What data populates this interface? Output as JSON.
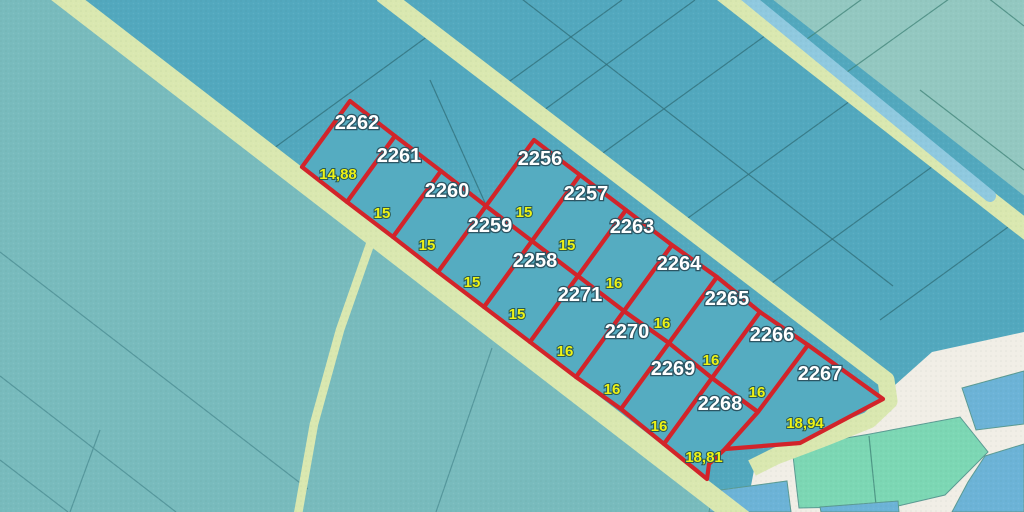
{
  "map": {
    "parcels": [
      {
        "number": "2262"
      },
      {
        "number": "2261"
      },
      {
        "number": "2260"
      },
      {
        "number": "2259"
      },
      {
        "number": "2258"
      },
      {
        "number": "2271"
      },
      {
        "number": "2270"
      },
      {
        "number": "2269"
      },
      {
        "number": "2268"
      },
      {
        "number": "2256"
      },
      {
        "number": "2257"
      },
      {
        "number": "2263"
      },
      {
        "number": "2264"
      },
      {
        "number": "2265"
      },
      {
        "number": "2266"
      },
      {
        "number": "2267"
      }
    ],
    "frontage_labels": [
      "14,88",
      "15",
      "15",
      "15",
      "15",
      "16",
      "16",
      "16",
      "18,81"
    ],
    "inner_labels": [
      "15",
      "15",
      "16",
      "16",
      "16",
      "16",
      "18,94"
    ],
    "colors": {
      "parcel_outline": "#D2242A",
      "parcel_fill": "#55ACC1",
      "field_blue": "#52A8BE",
      "field_teal": "#78BBBD",
      "field_green": "#93C8C1",
      "road_strip": "#DAE8B0",
      "stream": "#8FC9DF",
      "built_area": "#F1EEE6",
      "village_parcel_mint": "#7CD7B4",
      "village_parcel_blue": "#6CB3D7",
      "parcel_number_color": "#FFFFFF",
      "measurement_color": "#EDF215"
    }
  }
}
